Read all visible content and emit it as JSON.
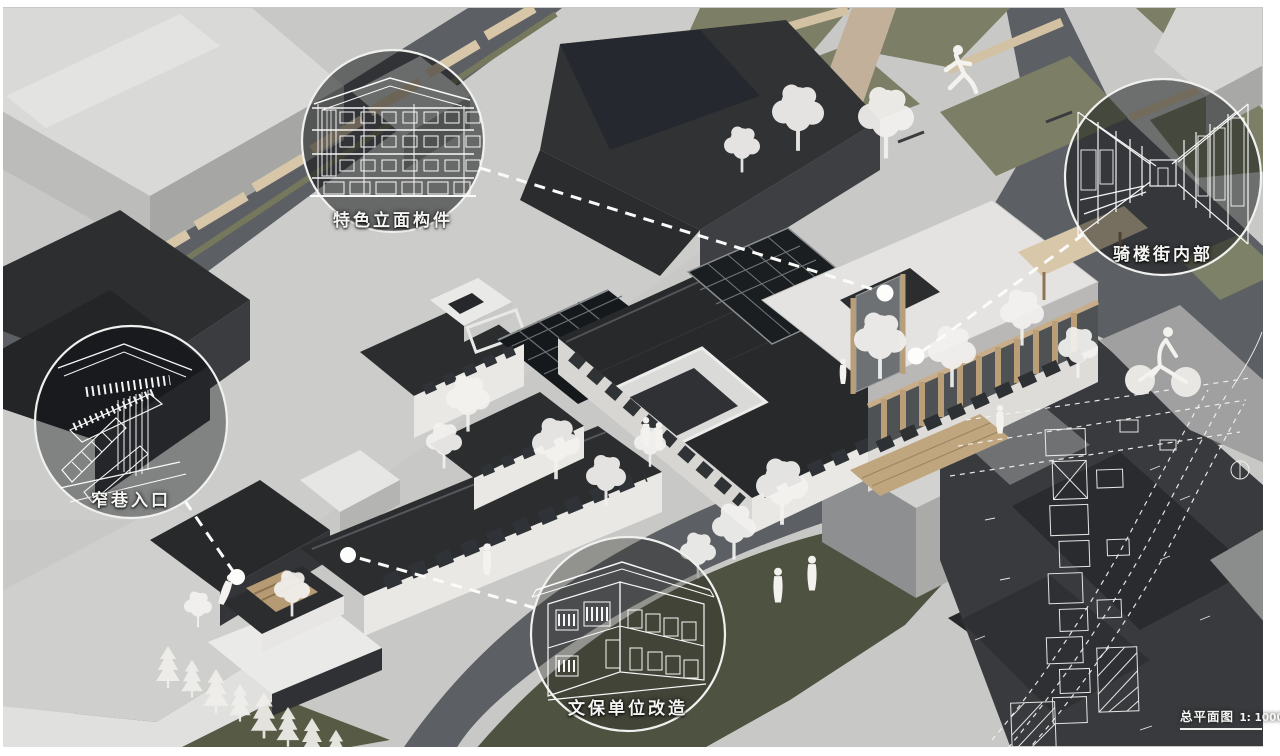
{
  "scene": {
    "type": "architectural-axonometric-rendering",
    "callouts": [
      {
        "id": "facade-components",
        "label": "特色立面构件"
      },
      {
        "id": "arcade-street-interior",
        "label": "骑楼街内部"
      },
      {
        "id": "narrow-alley-entrance",
        "label": "窄巷入口"
      },
      {
        "id": "heritage-building-renovation",
        "label": "文保单位改造"
      }
    ],
    "site_plan": {
      "title": "总平面图",
      "scale": "1: 1000"
    },
    "figures": [
      "runner-silhouette",
      "cyclist-silhouette",
      "pedestrian-silhouettes",
      "ghost-trees"
    ],
    "colors": {
      "background": "#c8c8c6",
      "road": "#5c5f63",
      "charcoal_roof": "#2a2c2e",
      "white_wall": "#eae9e6",
      "wood": "#b99e78",
      "greenery": "#6d7158",
      "lawn": "#4e5240",
      "ghost_white": "#f3f2ef",
      "callout_line": "#ffffff"
    }
  }
}
